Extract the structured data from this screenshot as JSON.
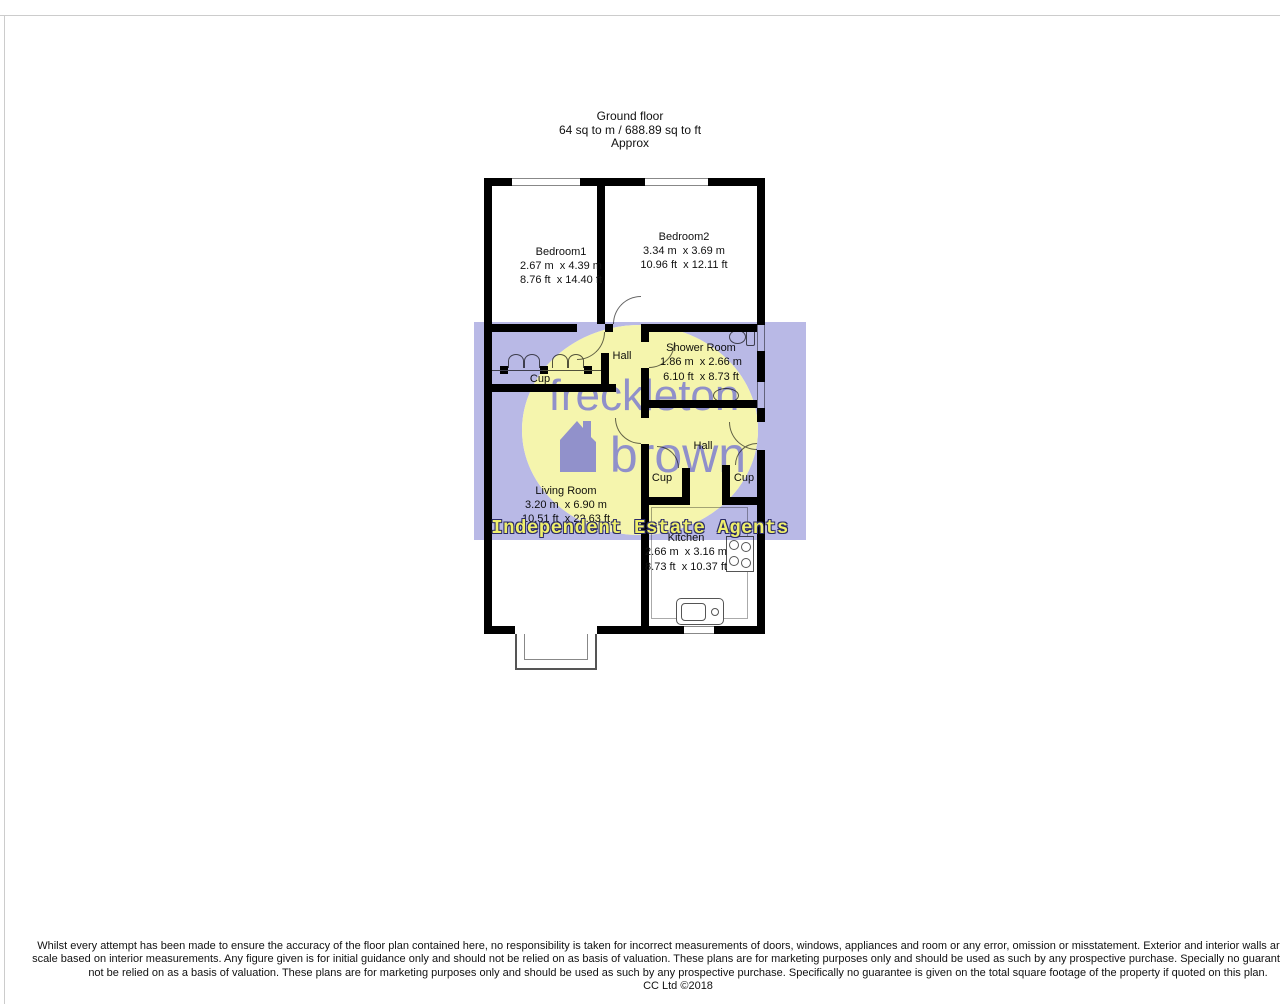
{
  "title": {
    "line1": "Ground floor",
    "line2": "64 sq to m / 688.89 sq to ft",
    "line3": "Approx"
  },
  "rooms": {
    "bedroom1": {
      "name": "Bedroom1",
      "metric": "2.67 m  x 4.39 m",
      "imperial": "8.76 ft  x 14.40 ft"
    },
    "bedroom2": {
      "name": "Bedroom2",
      "metric": "3.34 m  x 3.69 m",
      "imperial": "10.96 ft  x 12.11 ft"
    },
    "shower_room": {
      "name": "Shower Room",
      "metric": "1.86 m  x 2.66 m",
      "imperial": "6.10 ft  x 8.73 ft"
    },
    "hall_upper": {
      "name": "Hall"
    },
    "cup_upper": {
      "name": "Cup"
    },
    "living_room": {
      "name": "Living Room",
      "metric": "3.20 m  x 6.90 m",
      "imperial": "10.51 ft  x 22.63 ft"
    },
    "hall_lower": {
      "name": "Hall"
    },
    "cup_left": {
      "name": "Cup"
    },
    "cup_right": {
      "name": "Cup"
    },
    "kitchen": {
      "name": "Kitchen",
      "metric": "2.66 m  x 3.16 m",
      "imperial": "8.73 ft  x 10.37 ft"
    }
  },
  "watermark": {
    "line1": "freckleton",
    "line2": "brown",
    "tagline": "Independent Estate Agents",
    "band_color": "#b9b9e6",
    "ellipse_color": "#f5f5ad",
    "logo_text_color": "#8686ce",
    "tagline_fill": "#efef6b",
    "tagline_outline": "#2b2b66"
  },
  "footer": {
    "line1": "Whilst every attempt has been made to ensure the accuracy of the floor plan contained here, no responsibility is taken for incorrect measurements of doors, windows, appliances and room or any error, omission or misstatement. Exterior and interior walls are drawn",
    "line2": "scale based on interior measurements. Any figure given is for initial guidance only and should not be relied on as basis of valuation. These plans are for marketing purposes only and should be used as such by any prospective purchase. Specially no guarantee is sho",
    "line3": "not be relied on as a basis of valuation. These plans are for marketing purposes only and should be used as such by any prospective purchase. Specifically no guarantee is given on the total square footage of the property if quoted on this plan.",
    "line4": "CC Ltd ©2018"
  },
  "colors": {
    "wall": "#000000",
    "frame_line": "#cccccc"
  }
}
